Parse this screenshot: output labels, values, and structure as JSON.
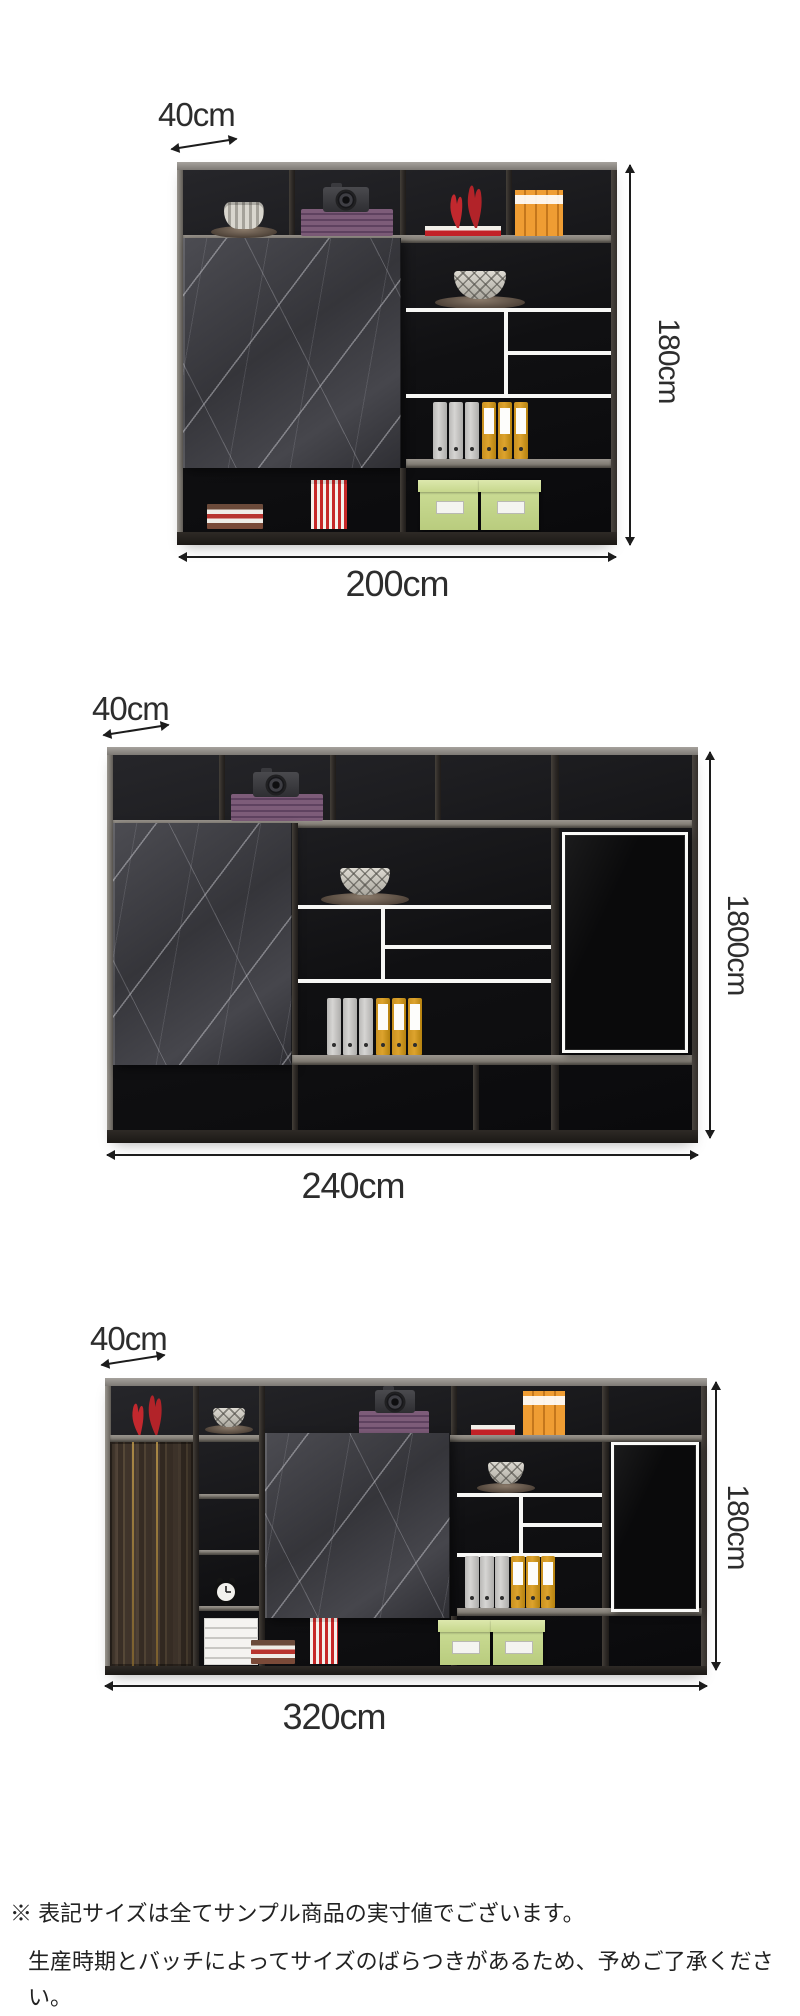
{
  "sections": [
    {
      "id": "bookcase-200",
      "depth_label": "40cm",
      "height_label": "180cm",
      "width_label": "200cm"
    },
    {
      "id": "bookcase-240",
      "depth_label": "40cm",
      "height_label": "1800cm",
      "width_label": "240cm"
    },
    {
      "id": "bookcase-320",
      "depth_label": "40cm",
      "height_label": "180cm",
      "width_label": "320cm"
    }
  ],
  "footnote": {
    "line1": "※ 表記サイズは全てサンプル商品の実寸値でございます。",
    "line2": "生産時期とバッチによってサイズのばらつきがあるため、予めご了承ください。"
  },
  "theme": {
    "colors": {
      "frame": "#332e2a",
      "frameTop": "#a6a29d",
      "interiorDark": "#101012",
      "shelf": "#9a958e",
      "whiteLine": "#f7f7f5",
      "marbleBase": "#3e3e44",
      "woodBase": "#4b3e33",
      "glassDoor": "#0a0a0b",
      "binderYellow": "#dda32e",
      "binderGray": "#d6d5d3",
      "boxGreen": "#cfe09a",
      "vaseRed": "#c0262c",
      "purpleBox": "#7d5c79",
      "orangeBook": "#ef9d33",
      "stripeRed": "#c62828",
      "dimText": "#2d2d2d",
      "noteText": "#222222"
    }
  }
}
